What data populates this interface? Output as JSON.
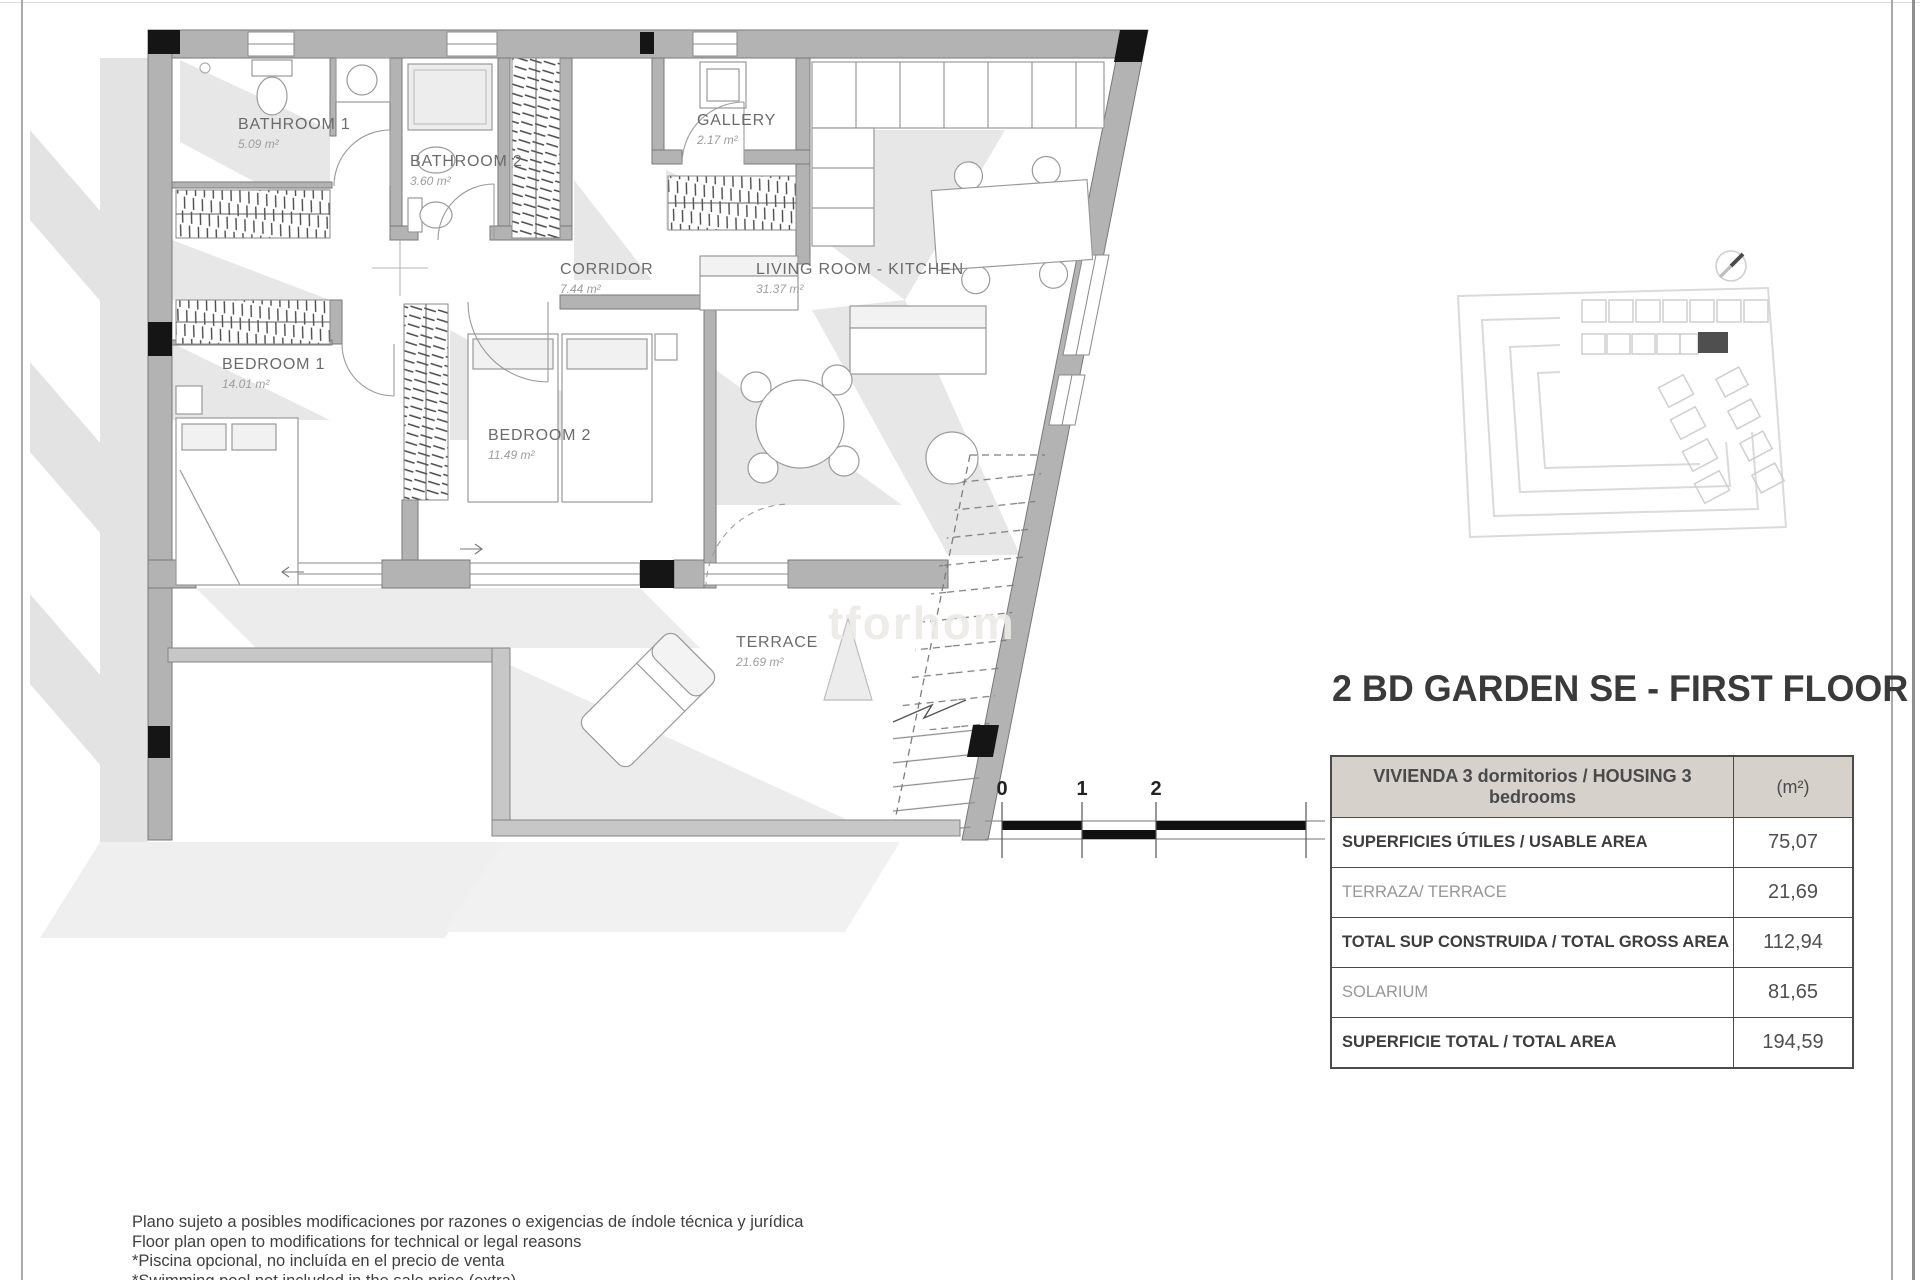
{
  "page": {
    "watermark_text": "tforhom"
  },
  "plan": {
    "rooms": [
      {
        "name": "BATHROOM 1",
        "area": "5.09 m²"
      },
      {
        "name": "BATHROOM 2",
        "area": "3.60 m²"
      },
      {
        "name": "GALLERY",
        "area": "2.17 m²"
      },
      {
        "name": "CORRIDOR",
        "area": "7.44 m²"
      },
      {
        "name": "LIVING ROOM - KITCHEN",
        "area": "31.37 m²"
      },
      {
        "name": "BEDROOM 1",
        "area": "14.01 m²"
      },
      {
        "name": "BEDROOM 2",
        "area": "11.49 m²"
      },
      {
        "name": "TERRACE",
        "area": "21.69 m²"
      }
    ]
  },
  "title": "2 BD GARDEN SE - FIRST FLOOR",
  "area_table": {
    "header": {
      "label": "VIVIENDA 3 dormitorios / HOUSING 3 bedrooms",
      "unit": "(m²)"
    },
    "rows": [
      {
        "label": "SUPERFICIES ÚTILES / USABLE AREA",
        "value": "75,07"
      },
      {
        "label": "TERRAZA/ TERRACE",
        "value": "21,69"
      },
      {
        "label": "TOTAL SUP CONSTRUIDA / TOTAL GROSS AREA",
        "value": "112,94"
      },
      {
        "label": "SOLARIUM",
        "value": "81,65"
      },
      {
        "label": "SUPERFICIE TOTAL / TOTAL  AREA",
        "value": "194,59"
      }
    ]
  },
  "scale_bar": {
    "labels": [
      "0",
      "1",
      "2",
      "4"
    ]
  },
  "footer_lines": [
    "Plano sujeto a posibles modificaciones por razones o exigencias de índole técnica y jurídica",
    "Floor plan open to modifications for technical or legal reasons",
    "*Piscina opcional, no incluída en el precio de venta",
    "*Swimming pool not included in the sale price (extra)"
  ],
  "colors": {
    "wall": "#b3b3b3",
    "wall_outline": "#787878",
    "column": "#151515",
    "highlight_unit": "#4f4f4f",
    "table_header_bg": "#d6d2cb"
  }
}
